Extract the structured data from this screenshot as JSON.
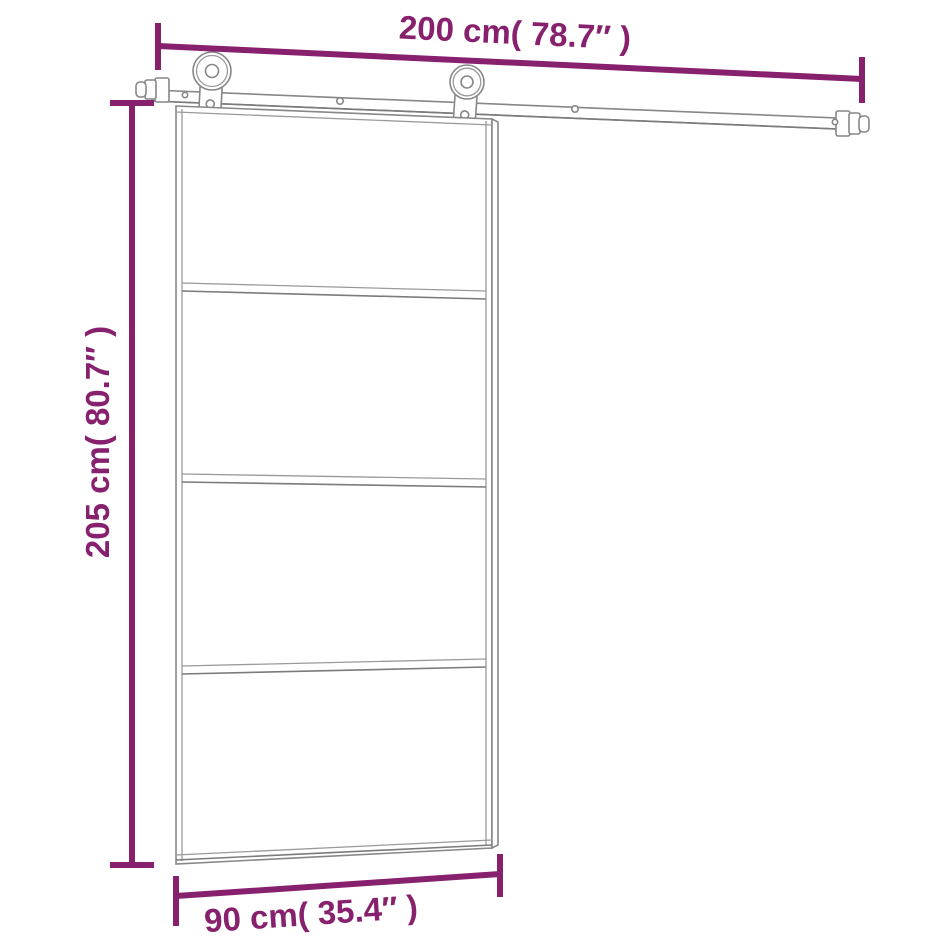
{
  "diagram": {
    "type": "product dimension diagram",
    "subject": "sliding glass door with rail hardware kit",
    "background": "#ffffff",
    "colors": {
      "dimension_accent": "#87216D",
      "line_art": "#878787"
    },
    "dimensions": {
      "top": {
        "label": "200 cm( 78.7″ )",
        "value_cm": 200,
        "value_inch": 78.7,
        "measures": "sliding rail width"
      },
      "left": {
        "label": "205 cm( 80.7″ )",
        "value_cm": 205,
        "value_inch": 80.7,
        "measures": "door height"
      },
      "bottom": {
        "label": "90 cm( 35.4″ )",
        "value_cm": 90,
        "value_inch": 35.4,
        "measures": "door width"
      }
    },
    "door": {
      "glass_panels": 4,
      "crossbars": 3,
      "rollers": 2
    }
  }
}
